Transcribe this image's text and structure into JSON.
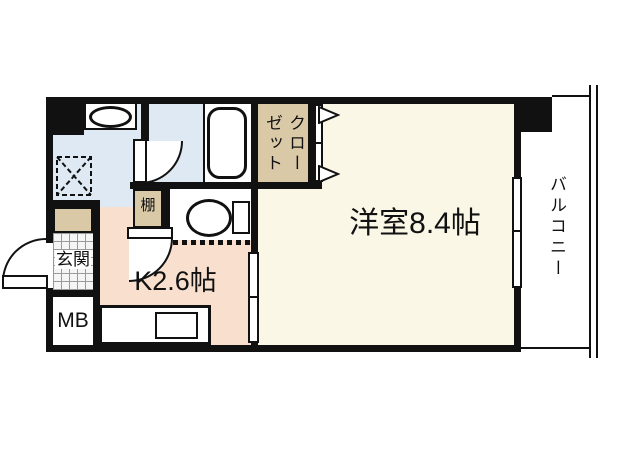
{
  "plan": {
    "type": "apartment-floor-plan",
    "rooms": {
      "western_room": {
        "label": "洋室8.4帖"
      },
      "kitchen": {
        "label": "K2.6帖"
      },
      "closet": {
        "label": "クローゼット"
      },
      "balcony": {
        "label": "バルコニー"
      },
      "entrance": {
        "label": "玄関"
      },
      "meter_box": {
        "label": "MB"
      },
      "shelf": {
        "label": "棚"
      }
    },
    "colors": {
      "wall": "#111111",
      "western_room_floor": "#faf7e6",
      "kitchen_floor": "#f8dfce",
      "wet_area_floor": "#dee9f3",
      "storage_fill": "#d9c9a7",
      "entrance_tile": "#f5f5f5",
      "fixture_fill": "#ffffff"
    }
  }
}
